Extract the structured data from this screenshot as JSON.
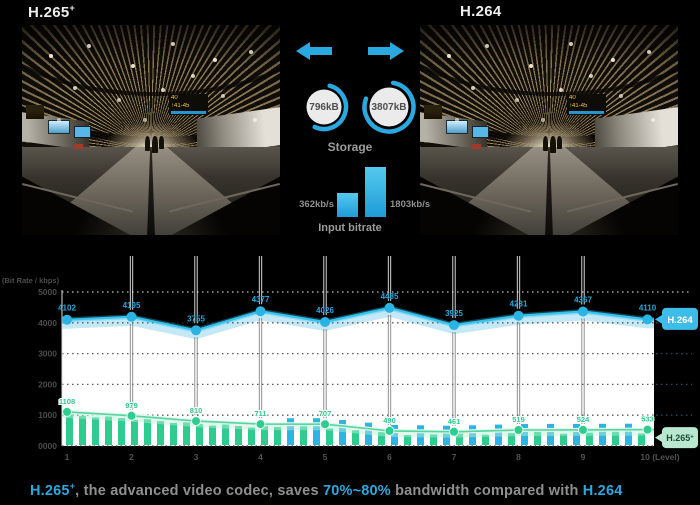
{
  "header": {
    "left_label": "H.265",
    "left_sup": "+",
    "right_label": "H.264"
  },
  "photo": {
    "gate_sign_line1": "40",
    "gate_sign_line2": "↑41-45"
  },
  "center": {
    "storage": {
      "left_value": "796kB",
      "right_value": "3807kB",
      "label": "Storage"
    },
    "bitrate": {
      "left_value": "362kb/s",
      "right_value": "1803kb/s",
      "label": "Input bitrate"
    }
  },
  "colors": {
    "accent_blue": "#2aa9e0",
    "line_blue": "#35c3ee",
    "bar_blue": "#2db4e2",
    "accent_green": "#2ecd8f",
    "legend_green_bg": "#b9e7cf"
  },
  "chart_data": {
    "type": "line",
    "title": "",
    "ylabel": "(Bit Rate / kbps)",
    "xlabel": "(Level)",
    "ylim": [
      0,
      5000
    ],
    "grid": "dotted-horizontal",
    "legend_position": "right",
    "x": [
      1,
      2,
      3,
      4,
      5,
      6,
      7,
      8,
      9,
      10
    ],
    "x_tick_labels": [
      "1",
      "2",
      "3",
      "4",
      "5",
      "6",
      "7",
      "8",
      "9",
      "10 (Level)"
    ],
    "y_ticks": [
      5000,
      4000,
      3000,
      2000,
      1000,
      0
    ],
    "y_tick_labels": [
      "5000",
      "4000",
      "3000",
      "2000",
      "1000",
      "0000"
    ],
    "series": [
      {
        "name": "H.264",
        "type": "line",
        "color": "#2bb3e3",
        "values": [
          4102,
          4195,
          3755,
          4377,
          4026,
          4485,
          3925,
          4231,
          4367,
          4110
        ]
      },
      {
        "name": "H.265+",
        "type": "line+bars",
        "color": "#2ecd8f",
        "values": [
          1108,
          979,
          810,
          711,
          707,
          490,
          461,
          519,
          524,
          533
        ]
      }
    ]
  },
  "caption": {
    "codec": "H.265",
    "codec_sup": "+",
    "mid1": ", the advanced video codec, saves ",
    "highlight": "70%~80%",
    "mid2": " bandwidth compared with ",
    "end_codec": "H.264"
  }
}
